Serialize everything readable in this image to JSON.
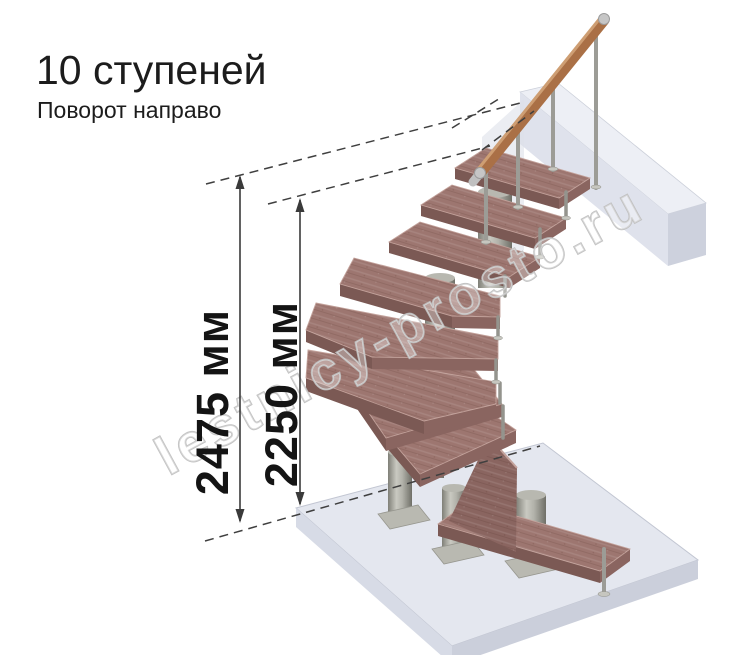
{
  "title": "10 ступеней",
  "subtitle": "Поворот направо",
  "steps_count": 10,
  "turn_direction": "направо",
  "dimensions": {
    "total_height": {
      "label": "2475 мм",
      "value": 2475,
      "unit": "мм"
    },
    "height_to_top_step": {
      "label": "2250 мм",
      "value": 2250,
      "unit": "мм"
    }
  },
  "watermark": "lestnicy-prosto.ru",
  "colors": {
    "background": "#ffffff",
    "text": "#1c1c1c",
    "dimension_lines": "#3a3a3a",
    "tread_top": "#9d7670",
    "tread_front": "#7b5954",
    "handrail_wood": "#aa7046",
    "metal_column": "#a9a9a1",
    "floor_slab": "#e4e7ef",
    "watermark_outline": "#c0c0c0"
  }
}
